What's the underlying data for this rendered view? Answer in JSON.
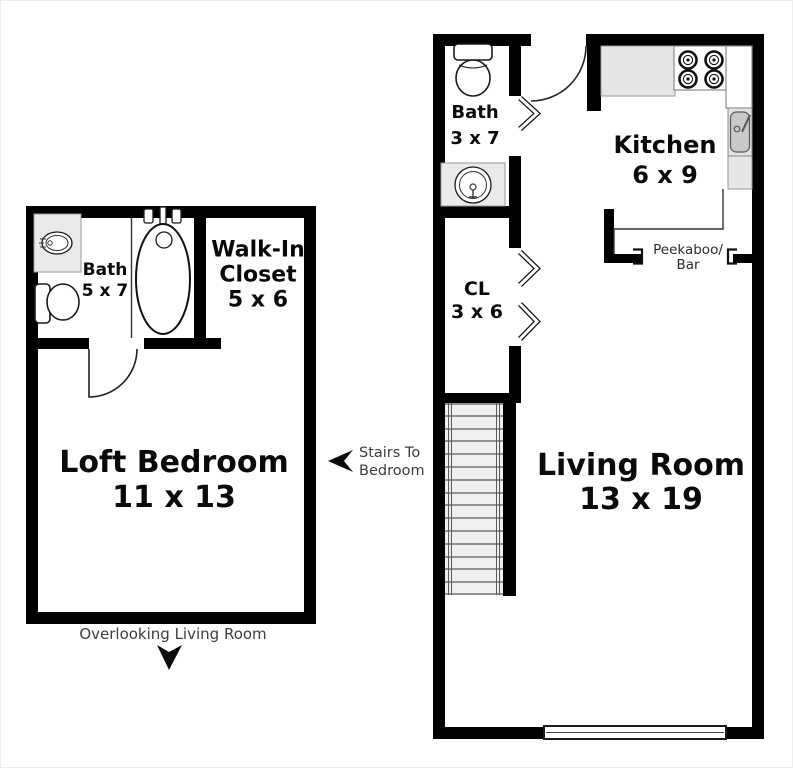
{
  "colors": {
    "wall": "#000000",
    "background": "#ffffff",
    "fixture_fill": "#eaeaea",
    "counter_fill": "#e6e6e6",
    "sink_basin_fill": "#c9c9c9",
    "stair_tread_fill": "#efefef",
    "room_label_text": "#0a0a0a",
    "annotation_text": "#3d3d3d"
  },
  "upper_floor_plan": {
    "bath": {
      "label": "Bath",
      "dims": "5 x 7"
    },
    "walk_in_closet": {
      "label_line1": "Walk-In",
      "label_line2": "Closet",
      "dims": "5 x 6"
    },
    "loft_bedroom": {
      "label": "Loft Bedroom",
      "dims": "11 x 13"
    },
    "note": "Overlooking Living Room",
    "fixtures": [
      "sink-vanity",
      "toilet",
      "bathtub",
      "door-swing"
    ]
  },
  "main_floor_plan": {
    "bath": {
      "label": "Bath",
      "dims": "3 x 7"
    },
    "closet": {
      "label": "CL",
      "dims": "3 x 6"
    },
    "kitchen": {
      "label": "Kitchen",
      "dims": "6 x 9"
    },
    "living_room": {
      "label": "Living Room",
      "dims": "13 x 19"
    },
    "peekaboo_bar": {
      "line1": "Peekaboo/",
      "line2": "Bar"
    },
    "fixtures": [
      "toilet",
      "sink-vanity",
      "entry-door-swing",
      "bifold-doors",
      "counter",
      "stove",
      "refrigerator",
      "kitchen-sink",
      "stairs",
      "window"
    ]
  },
  "stairs_annotation": {
    "line1": "Stairs To",
    "line2": "Bedroom"
  }
}
